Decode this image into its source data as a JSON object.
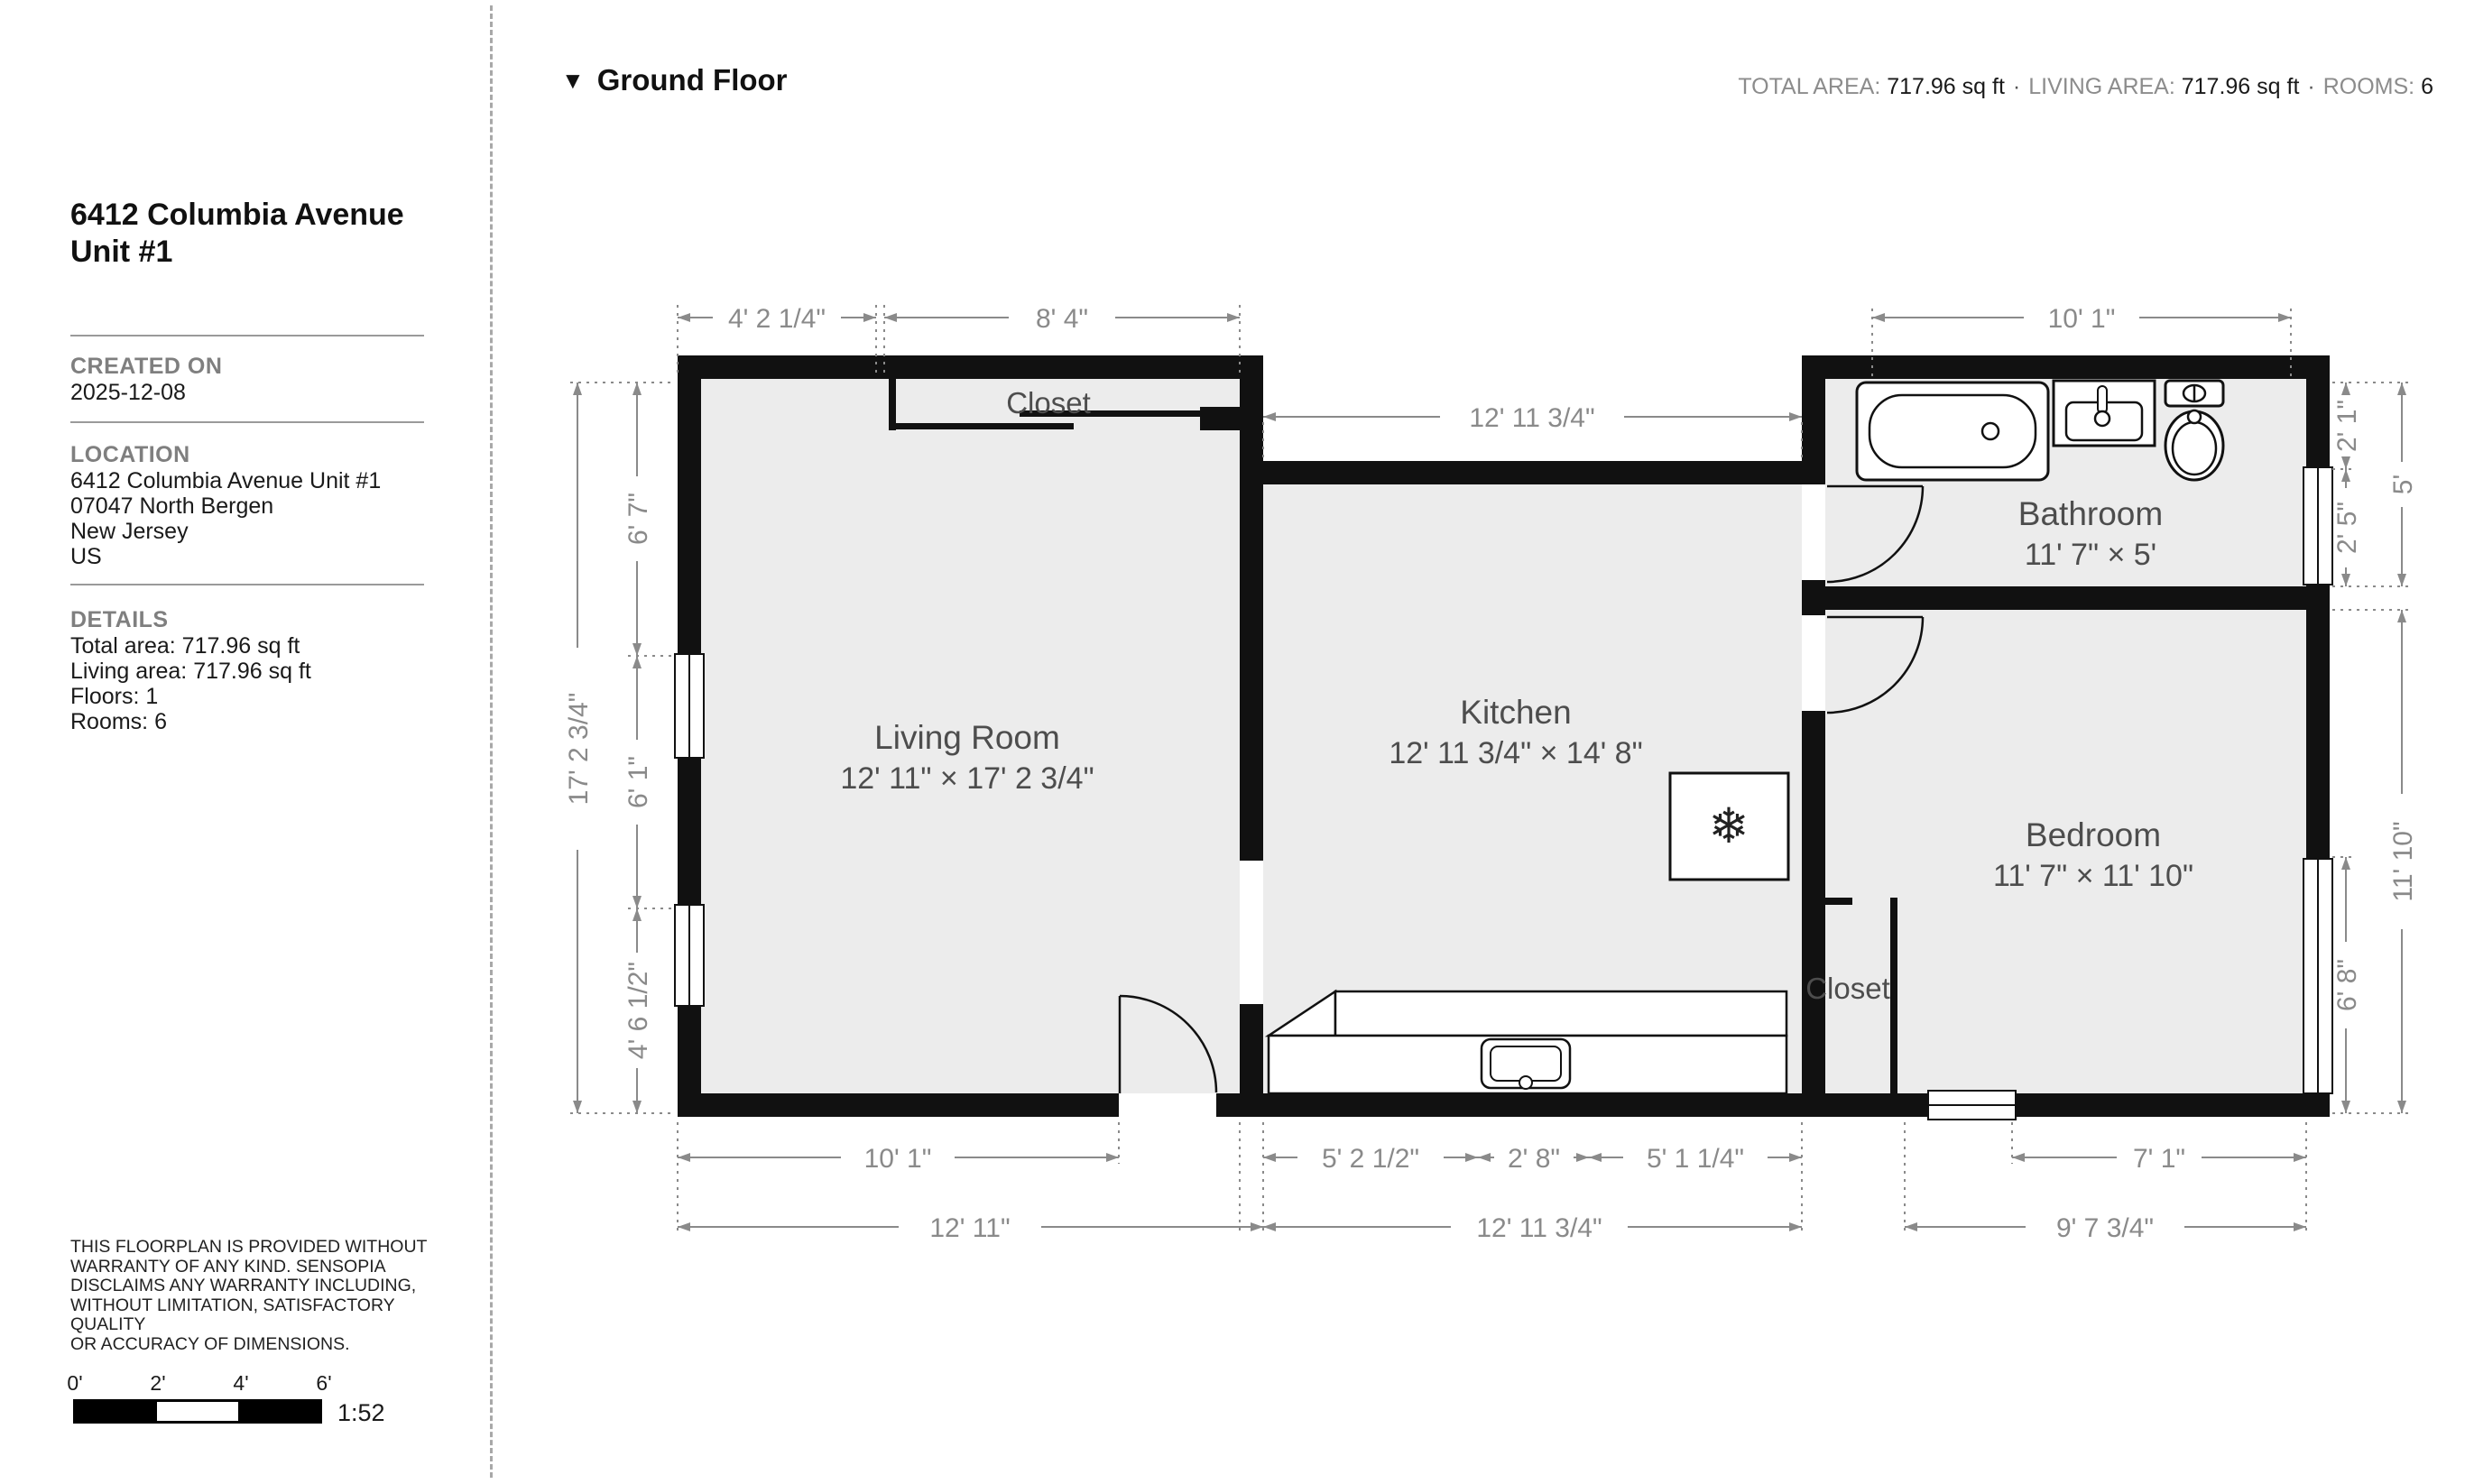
{
  "sidebar": {
    "title_line1": "6412 Columbia Avenue",
    "title_line2": "Unit #1",
    "created_on": {
      "label": "CREATED ON",
      "value": "2025-12-08"
    },
    "location": {
      "label": "LOCATION",
      "lines": [
        "6412 Columbia Avenue Unit #1",
        "07047 North Bergen",
        "New Jersey",
        "US"
      ]
    },
    "details": {
      "label": "DETAILS",
      "lines": [
        "Total area: 717.96 sq ft",
        "Living area: 717.96 sq ft",
        "Floors: 1",
        "Rooms: 6"
      ]
    },
    "disclaimer_lines": [
      "THIS FLOORPLAN IS PROVIDED WITHOUT",
      "WARRANTY OF ANY KIND. SENSOPIA",
      "DISCLAIMS ANY WARRANTY INCLUDING,",
      "WITHOUT LIMITATION, SATISFACTORY QUALITY",
      "OR ACCURACY OF DIMENSIONS."
    ],
    "scale": {
      "ticks": [
        "0'",
        "2'",
        "4'",
        "6'"
      ],
      "ratio": "1:52"
    }
  },
  "header": {
    "floor_label": "Ground Floor",
    "separator": "·",
    "stats": [
      {
        "label": "TOTAL AREA:",
        "value": "717.96 sq ft"
      },
      {
        "label": "LIVING AREA:",
        "value": "717.96 sq ft"
      },
      {
        "label": "ROOMS:",
        "value": "6"
      }
    ]
  },
  "plan": {
    "rooms": {
      "living_room": {
        "name": "Living Room",
        "size": "12' 11\" × 17' 2 3/4\""
      },
      "kitchen": {
        "name": "Kitchen",
        "size": "12' 11 3/4\" × 14' 8\""
      },
      "bathroom": {
        "name": "Bathroom",
        "size": "11' 7\" × 5'"
      },
      "bedroom": {
        "name": "Bedroom",
        "size": "11' 7\" × 11' 10\""
      },
      "closet_top": {
        "name": "Closet"
      },
      "closet_bedroom": {
        "name": "Closet"
      }
    },
    "dims": {
      "top_left": "4' 2 1/4\"",
      "top_mid": "8' 4\"",
      "top_right": "10' 1\"",
      "kitchen_width": "12' 11 3/4\"",
      "b1_lr": "10' 1\"",
      "b1_k1": "5' 2 1/2\"",
      "b1_k2": "2' 8\"",
      "b1_k3": "5' 1 1/4\"",
      "b1_bed": "7' 1\"",
      "b2_lr": "12' 11\"",
      "b2_k": "12' 11 3/4\"",
      "b2_bed": "9' 7 3/4\"",
      "l_out": "17' 2 3/4\"",
      "l_in1": "6' 7\"",
      "l_in2": "6' 1\"",
      "l_in3": "4' 6 1/2\"",
      "r_in1": "2' 1\"",
      "r_in2": "2' 5\"",
      "r_in3": "6' 8\"",
      "r_out1": "5'",
      "r_out2": "11' 10\"",
      "snowflake_icon": "❄"
    },
    "colors": {
      "wall": "#111111",
      "floor": "#ececec",
      "dimension": "#8a8a8a",
      "room_label": "#4d4d4d"
    }
  }
}
